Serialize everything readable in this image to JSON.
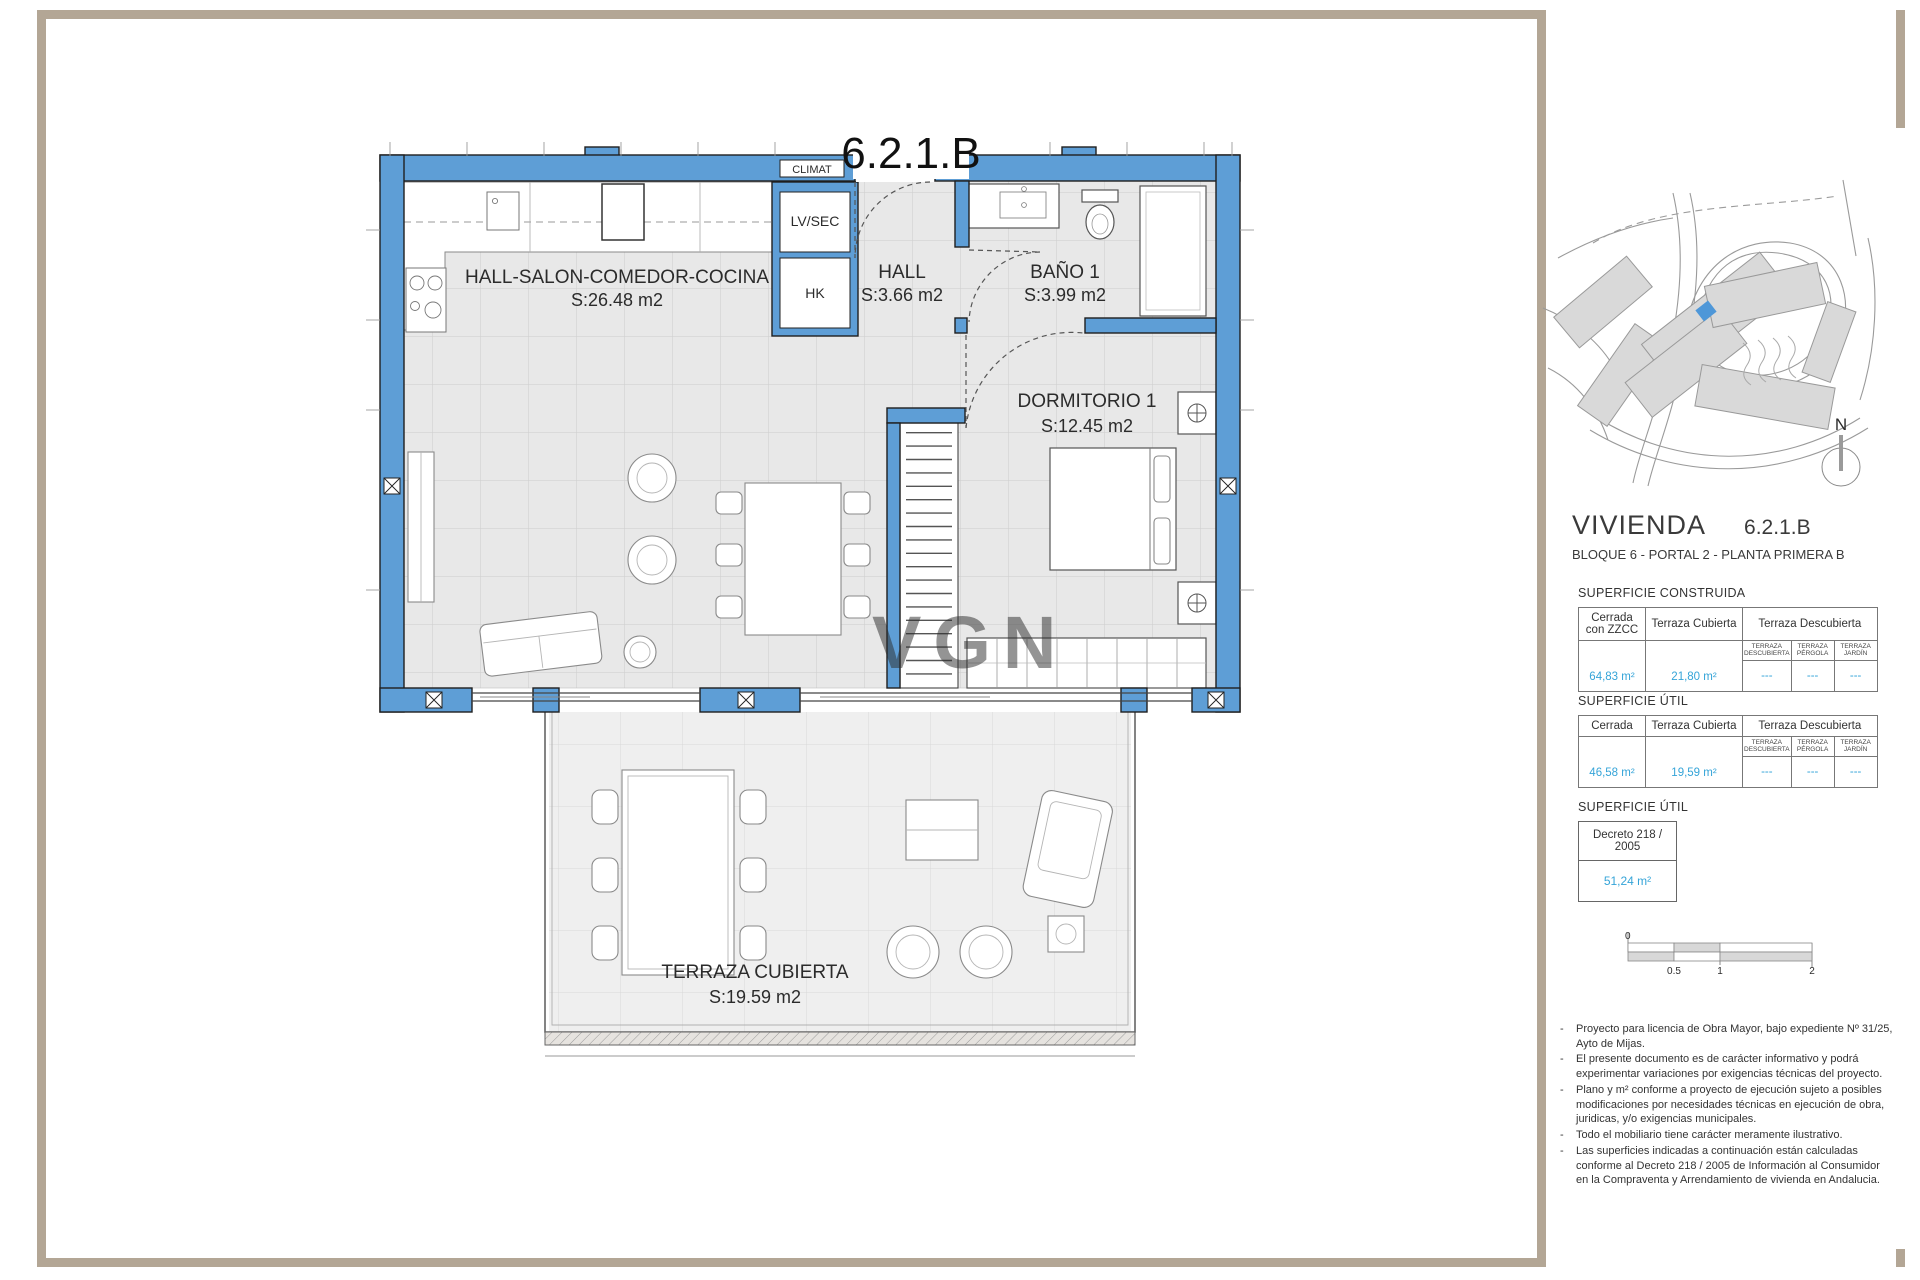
{
  "plan": {
    "title": "6.2.1.B",
    "labels": {
      "climat": "CLIMAT",
      "lvsec": "LV/SEC",
      "hk": "HK"
    },
    "watermark": "VGN",
    "rooms": [
      {
        "name": "HALL-SALON-COMEDOR-COCINA",
        "area": "S:26.48 m2"
      },
      {
        "name": "HALL",
        "area": "S:3.66 m2"
      },
      {
        "name": "BAÑO 1",
        "area": "S:3.99 m2"
      },
      {
        "name": "DORMITORIO 1",
        "area": "S:12.45 m2"
      },
      {
        "name": "TERRAZA CUBIERTA",
        "area": "S:19.59 m2"
      }
    ]
  },
  "panel": {
    "north_label": "N",
    "vivienda": {
      "label": "VIVIENDA",
      "unit": "6.2.1.B",
      "subtitle": "BLOQUE 6 - PORTAL 2 - PLANTA PRIMERA B"
    },
    "superficie_construida": {
      "title": "SUPERFICIE CONSTRUIDA",
      "columns": [
        "Cerrada con ZZCC",
        "Terraza Cubierta",
        "Terraza Descubierta"
      ],
      "subcolumns": [
        "TERRAZA DESCUBIERTA",
        "TERRAZA PÉRGOLA",
        "TERRAZA JARDÍN"
      ],
      "values": [
        "64,83 m²",
        "21,80 m²",
        "---",
        "---",
        "---"
      ]
    },
    "superficie_util": {
      "title": "SUPERFICIE ÚTIL",
      "columns": [
        "Cerrada",
        "Terraza Cubierta",
        "Terraza Descubierta"
      ],
      "subcolumns": [
        "TERRAZA DESCUBIERTA",
        "TERRAZA PÉRGOLA",
        "TERRAZA JARDÍN"
      ],
      "values": [
        "46,58 m²",
        "19,59 m²",
        "---",
        "---",
        "---"
      ]
    },
    "superficie_util_decreto": {
      "title": "SUPERFICIE ÚTIL",
      "box_label": "Decreto  218 / 2005",
      "value": "51,24 m²"
    },
    "scalebar": {
      "labels": [
        "0",
        "0.5",
        "1",
        "2"
      ]
    },
    "bullet": "-",
    "notes": [
      "Proyecto para licencia de Obra Mayor, bajo expediente Nº 31/25, Ayto de Mijas.",
      "El presente documento es de carácter informativo y podrá experimentar variaciones por exigencias técnicas del proyecto.",
      "Plano y m² conforme a proyecto de ejecución sujeto a posibles modificaciones por necesidades técnicas en ejecución de obra, juridicas, y/o exigencias municipales.",
      "Todo el mobiliario tiene carácter meramente ilustrativo.",
      "Las superficies indicadas a continuación están calculadas conforme al Decreto 218 / 2005  de Información al Consumidor en la Compraventa y Arrendamiento de vivienda en Andalucia."
    ]
  },
  "colors": {
    "wall": "#5e9ed6",
    "accent": "#35a4d8",
    "frame": "#b3a695"
  }
}
